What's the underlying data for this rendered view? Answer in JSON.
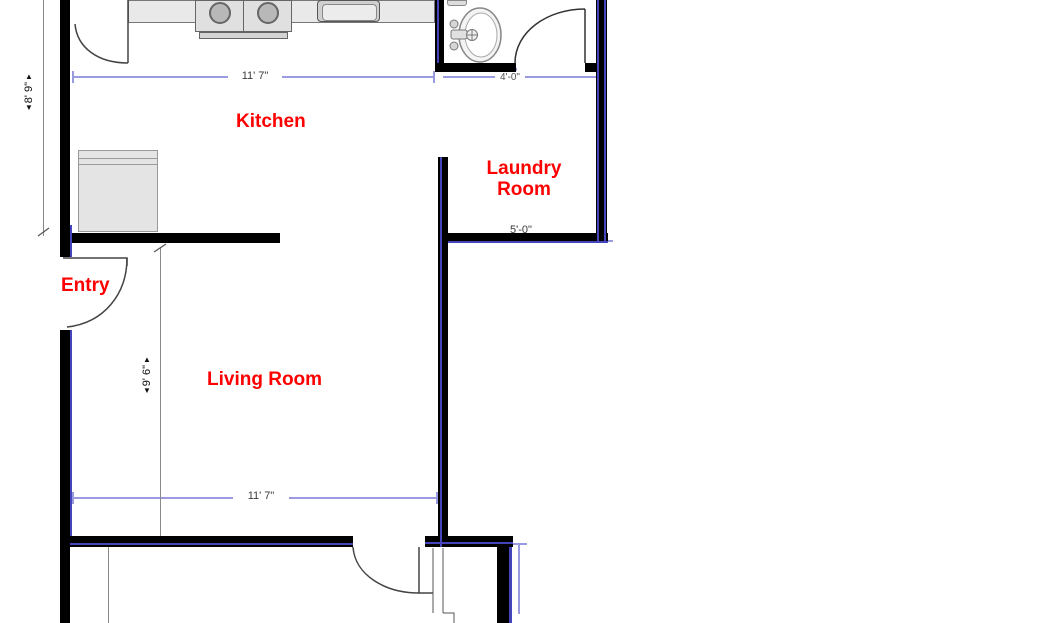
{
  "rooms": {
    "kitchen": {
      "label": "Kitchen"
    },
    "laundry": {
      "label_line1": "Laundry",
      "label_line2": "Room"
    },
    "entry": {
      "label": "Entry"
    },
    "living": {
      "label": "Living Room"
    }
  },
  "dimensions": {
    "kitchen_width_top": "11' 7\"",
    "kitchen_height_left": "8' 9\"",
    "living_height": "9' 6\"",
    "living_width_bottom": "11' 7\"",
    "laundry_width": "5'-0\"",
    "bath_width": "4'-0\"",
    "up_arrow": "▲",
    "down_arrow": "▼"
  },
  "fixtures": [
    "kitchen-counter",
    "stove",
    "kitchen-sink",
    "refrigerator",
    "bathroom-sink",
    "toilet",
    "door-swings"
  ],
  "colors": {
    "label": "#ff0000",
    "wall": "#000000",
    "wall_accent": "#4444bb",
    "dim_line": "#9a9ae0",
    "dim_text": "#3a3a3a"
  }
}
